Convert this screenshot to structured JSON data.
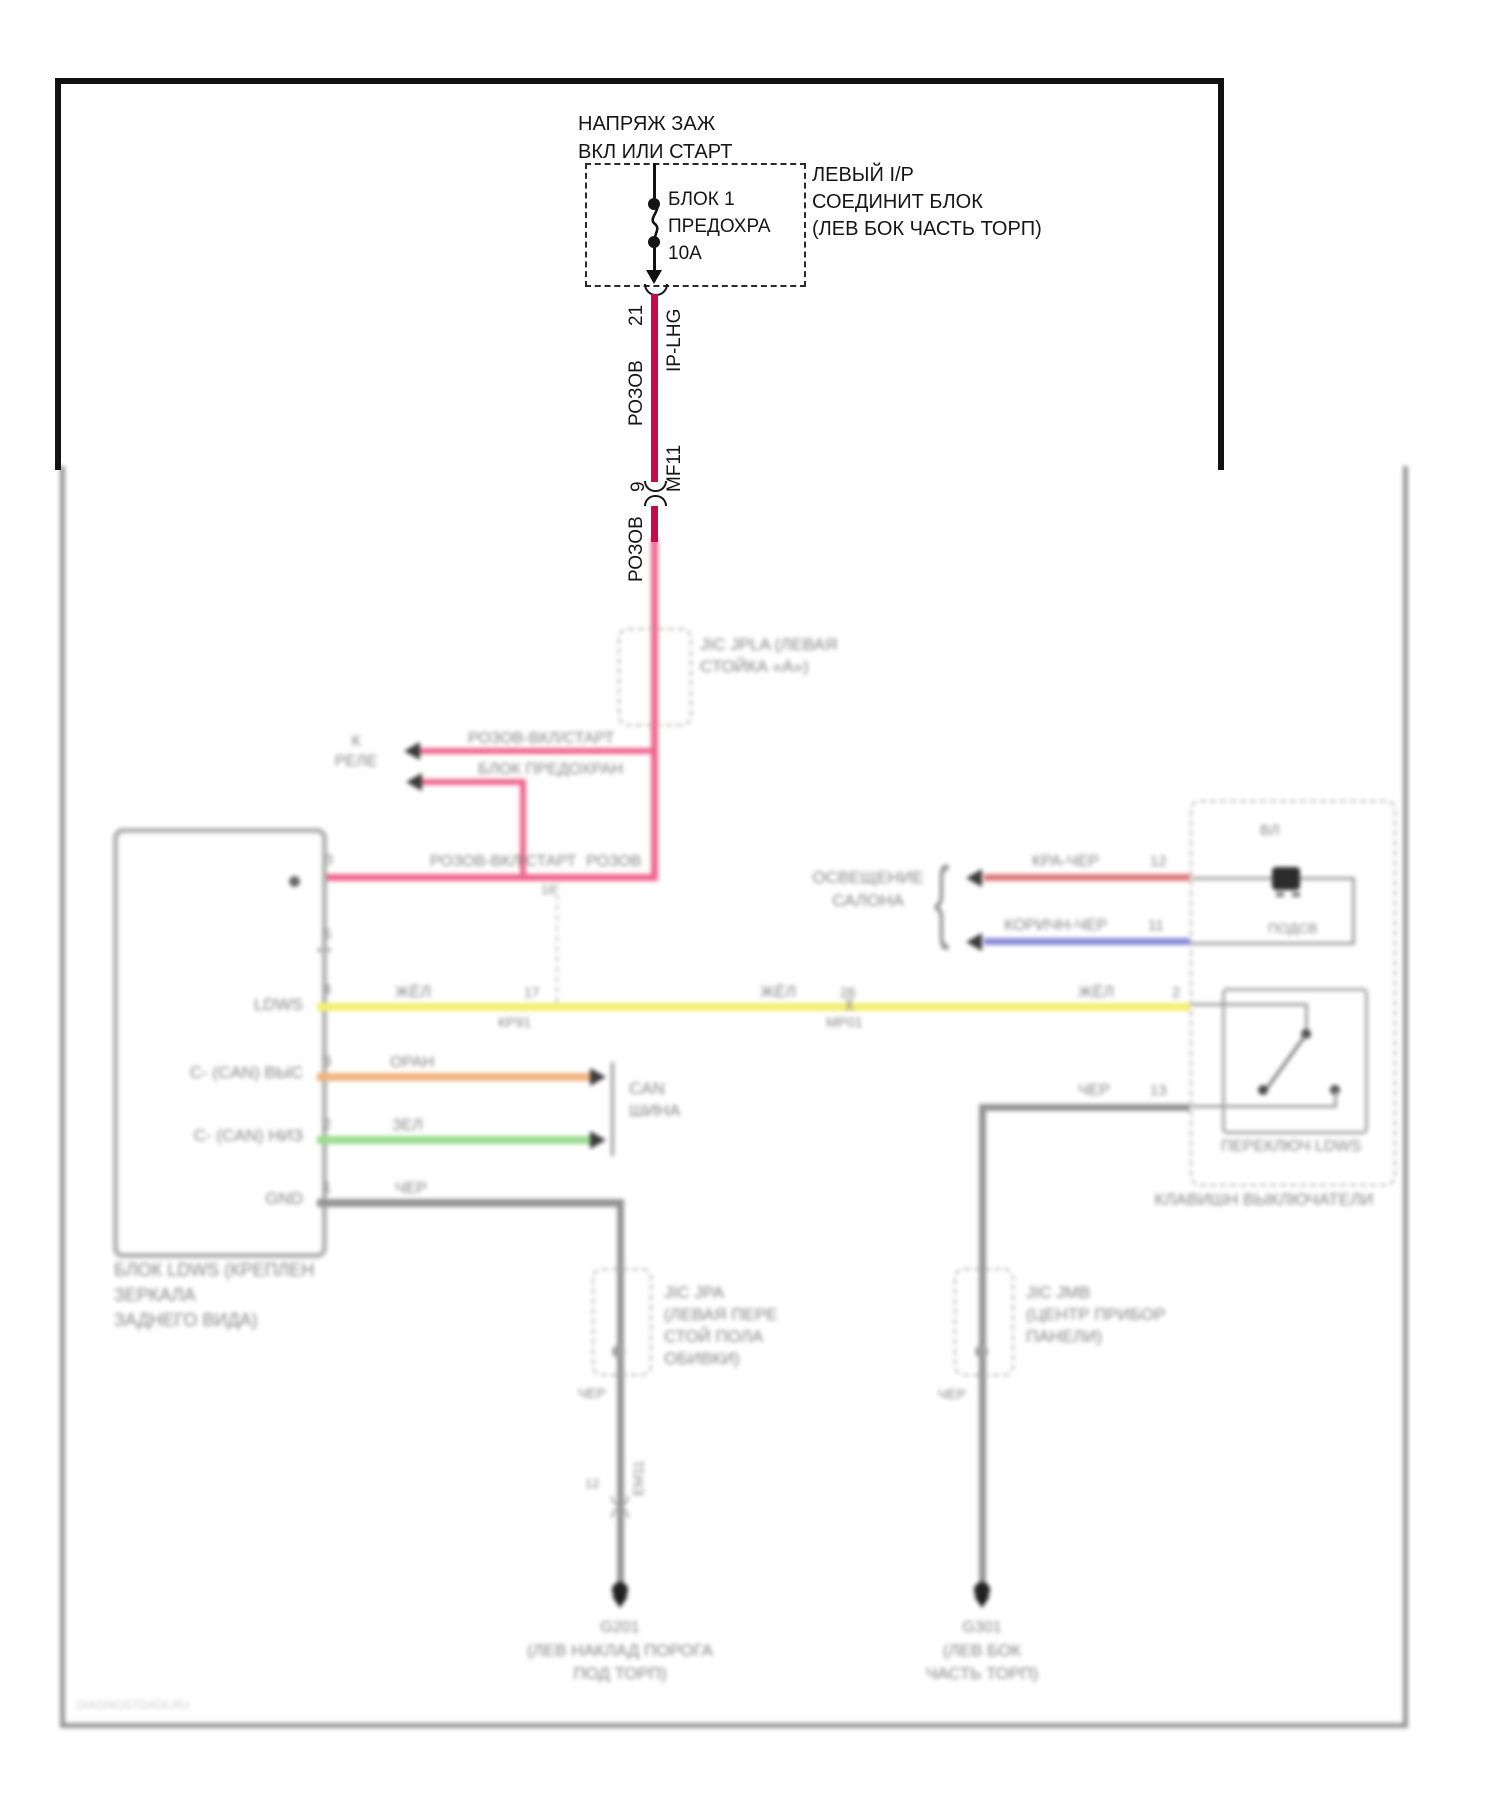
{
  "diagram": {
    "power_source": {
      "line1": "НАПРЯЖ ЗАЖ",
      "line2": "ВКЛ ИЛИ СТАРТ"
    },
    "fuse": {
      "name": "БЛОК 1",
      "desc": "ПРЕДОХРА",
      "rating": "10А"
    },
    "ip_block": {
      "line1": "ЛЕВЫЙ I/P",
      "line2": "СОЕДИНИТ БЛОК",
      "line3": "(ЛЕВ БОК ЧАСТЬ ТОРП)"
    },
    "feed": {
      "pin": "21",
      "connector": "IP-LHG",
      "wire_color": "РОЗОВ",
      "inline_pin": "9",
      "inline_connector": "MF11",
      "wire_color2": "РОЗОВ",
      "pin_c": "16"
    },
    "jpla": {
      "line1": "JIC JPLA (ЛЕВАЯ",
      "line2": "СТОЙКА «А»)"
    },
    "branches": {
      "dest1": "К",
      "dest2": "РЕЛЕ",
      "label1": "РОЗОВ-ВКЛ/СТАРТ",
      "label2": "БЛОК ПРЕДОХРАН"
    },
    "main_feed": {
      "label1": "РОЗОВ-ВКЛ/СТАРТ",
      "label2": "РОЗОВ",
      "pin": "6"
    },
    "ldws": {
      "pins": [
        "6",
        "5",
        "4",
        "3",
        "2",
        "1"
      ],
      "inputs": {
        "ldws": "LDWS",
        "can_high": "C- (CAN) ВЫС",
        "can_low": "C- (CAN) НИЗ",
        "gnd": "GND"
      },
      "caption": [
        "БЛОК LDWS (КРЕПЛЕН",
        "ЗЕРКАЛА",
        "ЗАДНЕГО ВИДА)"
      ]
    },
    "yellow": {
      "color_label": "ЖЁЛ",
      "inline1_pin": "17",
      "inline1_name": "КР91",
      "inline2_pin": "26",
      "inline2_name": "МР01",
      "break": ")(",
      "right_pin": "2"
    },
    "orange": {
      "color_label": "ОРАН"
    },
    "green": {
      "color_label": "ЗЕЛ"
    },
    "black": {
      "color_label": "ЧЕР"
    },
    "can_bus": {
      "line1": "CAN",
      "line2": "ШИНА"
    },
    "lighting": {
      "line1": "ОСВЕЩЕНИЕ",
      "line2": "САЛОНА",
      "red_label": "КРА-ЧЕР",
      "red_pin": "12",
      "blue_label": "КОРИЧН-ЧЕР",
      "blue_pin": "11"
    },
    "switch_box": {
      "top_label": "ВЛ",
      "lamp_label": "ПОДСВ",
      "black_label": "ЧЕР",
      "black_pin": "13",
      "switch_caption": "ПЕРЕКЛЮЧ LDWS",
      "box_caption": "КЛАВИШН ВЫКЛЮЧАТЕЛИ"
    },
    "jpa": {
      "line1": "JIC JPA",
      "line2": "(ЛЕВАЯ ПЕРЕ",
      "line3": "СТОЙ ПОЛА",
      "line4": "ОБИВКИ)",
      "wire_label": "ЧЕР",
      "pin_label": "12",
      "inline_name": "ЕМ11"
    },
    "jmb": {
      "line1": "JIC JMB",
      "line2": "(ЦЕНТР ПРИБОР",
      "line3": "ПАНЕЛИ)",
      "wire_label": "ЧЕР"
    },
    "ground1": {
      "name": "G201",
      "line1": "(ЛЕВ НАКЛАД ПОРОГА",
      "line2": "ПОД ТОРП)"
    },
    "ground2": {
      "name": "G301",
      "line1": "(ЛЕВ БОК",
      "line2": "ЧАСТЬ ТОРП)"
    },
    "watermark": "DIAGNOSTDATA.RU",
    "colors": {
      "feed": "#c8094e",
      "feed_blur": "#ee5c88",
      "yellow": "#f3ee67",
      "orange": "#f0ae75",
      "green": "#93da87",
      "black_wire": "#8d8d8d",
      "red": "#dd6f6f",
      "blue": "#8181d6"
    }
  }
}
